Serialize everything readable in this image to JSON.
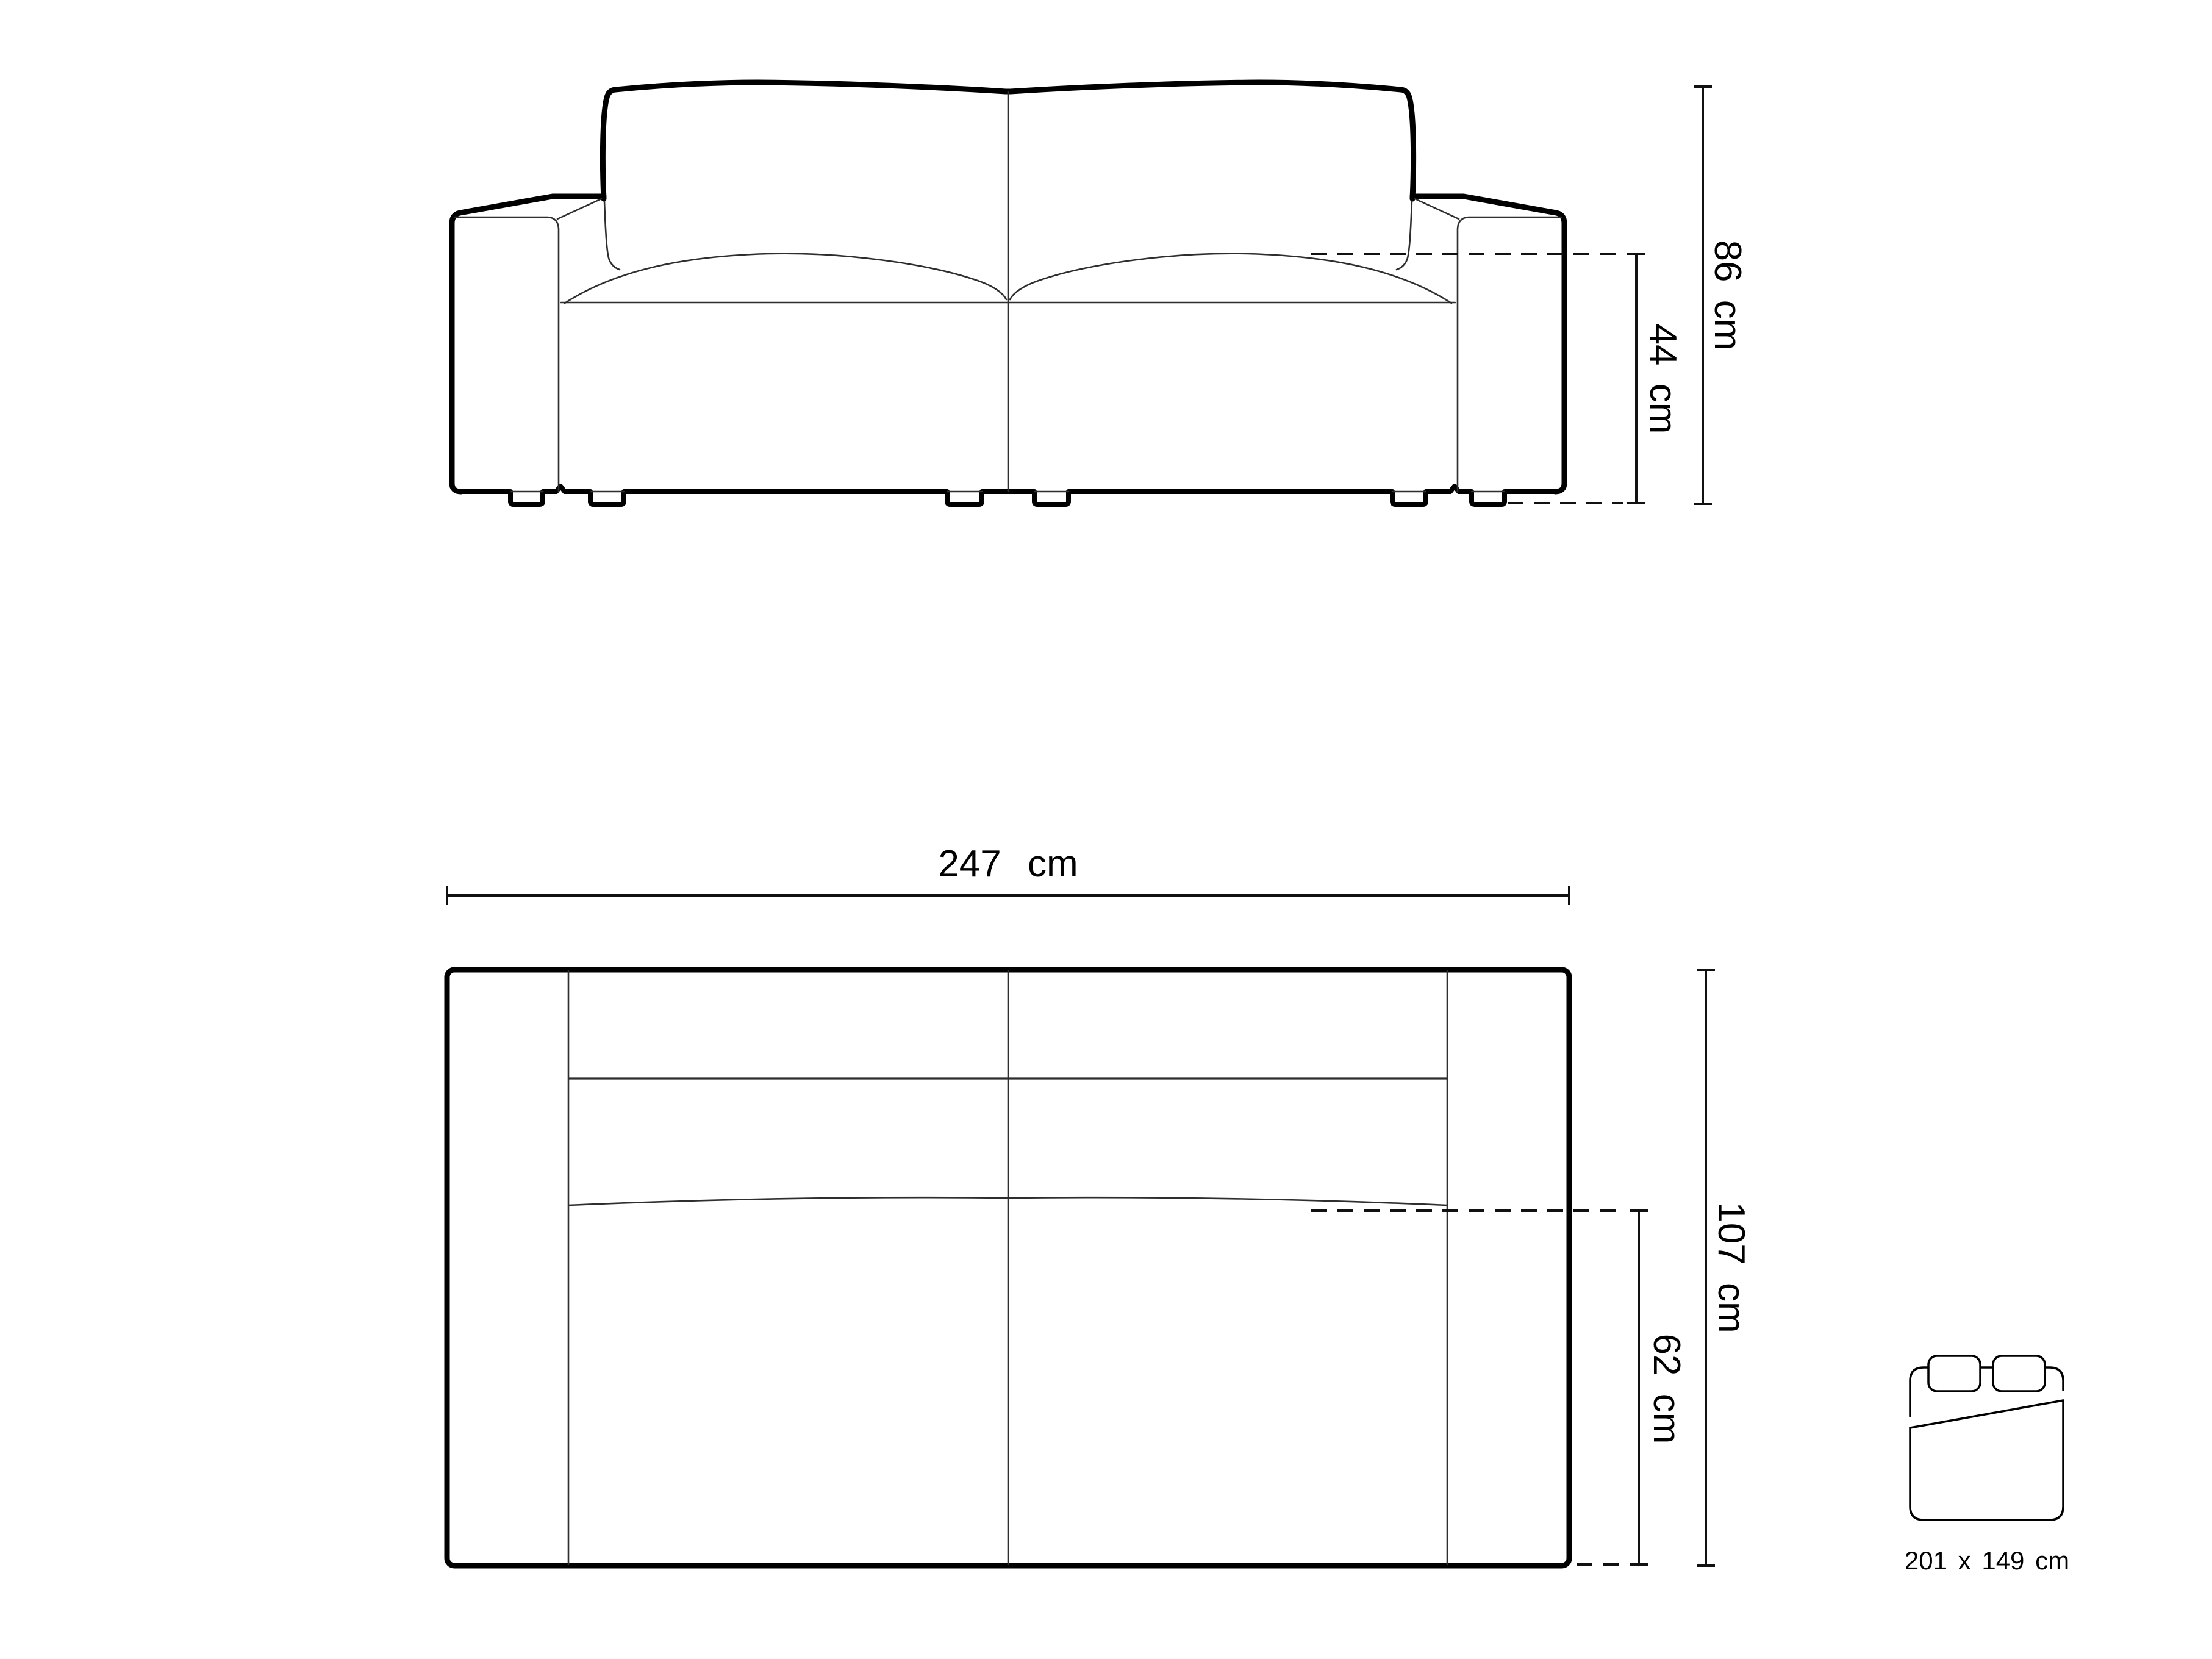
{
  "diagram": {
    "type": "furniture-dimension-drawing",
    "subject": "two-seat sofa technical drawing, front elevation and top plan",
    "colors": {
      "background": "#ffffff",
      "outline": "#000000",
      "thin_line": "#2e2e2e",
      "dimension_line": "#111111"
    },
    "front_view": {
      "name": "front elevation of sofa",
      "dimensions": {
        "total_height": {
          "label": "86 cm",
          "orientation": "vertical"
        },
        "seat_height": {
          "label": "44 cm",
          "orientation": "vertical"
        }
      }
    },
    "top_view": {
      "name": "top plan of sofa",
      "dimensions": {
        "total_width": {
          "label": "247 cm",
          "orientation": "horizontal"
        },
        "total_depth": {
          "label": "107 cm",
          "orientation": "vertical"
        },
        "seat_depth": {
          "label": "62 cm",
          "orientation": "vertical"
        }
      }
    },
    "sleeping_area": {
      "name": "sleeping surface pictogram",
      "label": "201 x 149 cm"
    }
  }
}
